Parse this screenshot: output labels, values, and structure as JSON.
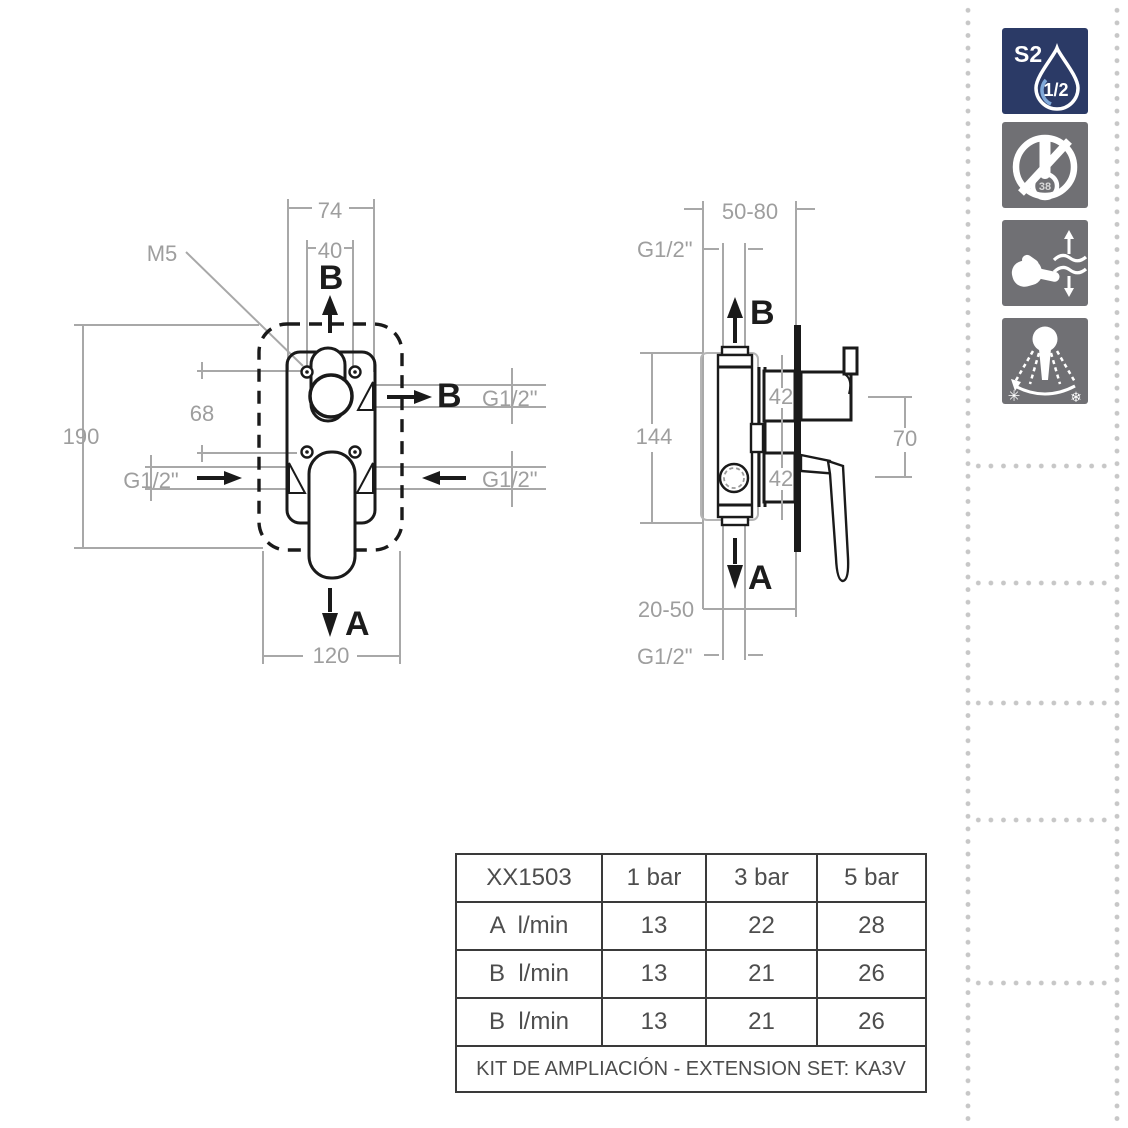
{
  "colors": {
    "line_black": "#1a1a1a",
    "dimension_gray": "#a8a8a8",
    "dimension_text_gray": "#9e9e9e",
    "dot_border_gray": "#c7c7c7",
    "icon_blue_bg": "#2b3a66",
    "icon_gray_bg": "#707074",
    "table_border": "#3a3a3a",
    "table_text": "#4d4d4d"
  },
  "front_view": {
    "labels": {
      "dim_outer_width": "74",
      "dim_inner_width": "40",
      "screw": "M5",
      "outlet_top": "B",
      "outlet_side": "B",
      "thread_outlet_side": "G1/2\"",
      "thread_inlet_left": "G1/2\"",
      "thread_inlet_right": "G1/2\"",
      "dim_port_offset": "68",
      "dim_height": "190",
      "outlet_bottom": "A",
      "dim_plate_width": "120"
    }
  },
  "side_view": {
    "labels": {
      "dim_depth_range": "50-80",
      "thread_top": "G1/2\"",
      "outlet_top": "B",
      "dim_port_top": "42",
      "dim_port_bottom": "42",
      "dim_handle_offset": "70",
      "dim_body_height": "144",
      "outlet_bottom": "A",
      "dim_embed_range": "20-50",
      "thread_bottom": "G1/2\""
    }
  },
  "sidebar": {
    "icons": [
      {
        "name": "flow-class-drop-icon",
        "badge": "S2",
        "drop_label": "1/2"
      },
      {
        "name": "no-thermostatic-limit-icon",
        "bulb_label": "38"
      },
      {
        "name": "hand-flow-adjust-icon"
      },
      {
        "name": "spray-angle-adjust-icon",
        "left_glyph": "✳",
        "right_glyph": "❄"
      }
    ]
  },
  "flow_table": {
    "headers": [
      "XX1503",
      "1 bar",
      "3 bar",
      "5 bar"
    ],
    "rows": [
      [
        "A  l/min",
        "13",
        "22",
        "28"
      ],
      [
        "B  l/min",
        "13",
        "21",
        "26"
      ],
      [
        "B  l/min",
        "13",
        "21",
        "26"
      ]
    ],
    "footer": "KIT DE AMPLIACIÓN - EXTENSION SET: KA3V"
  }
}
